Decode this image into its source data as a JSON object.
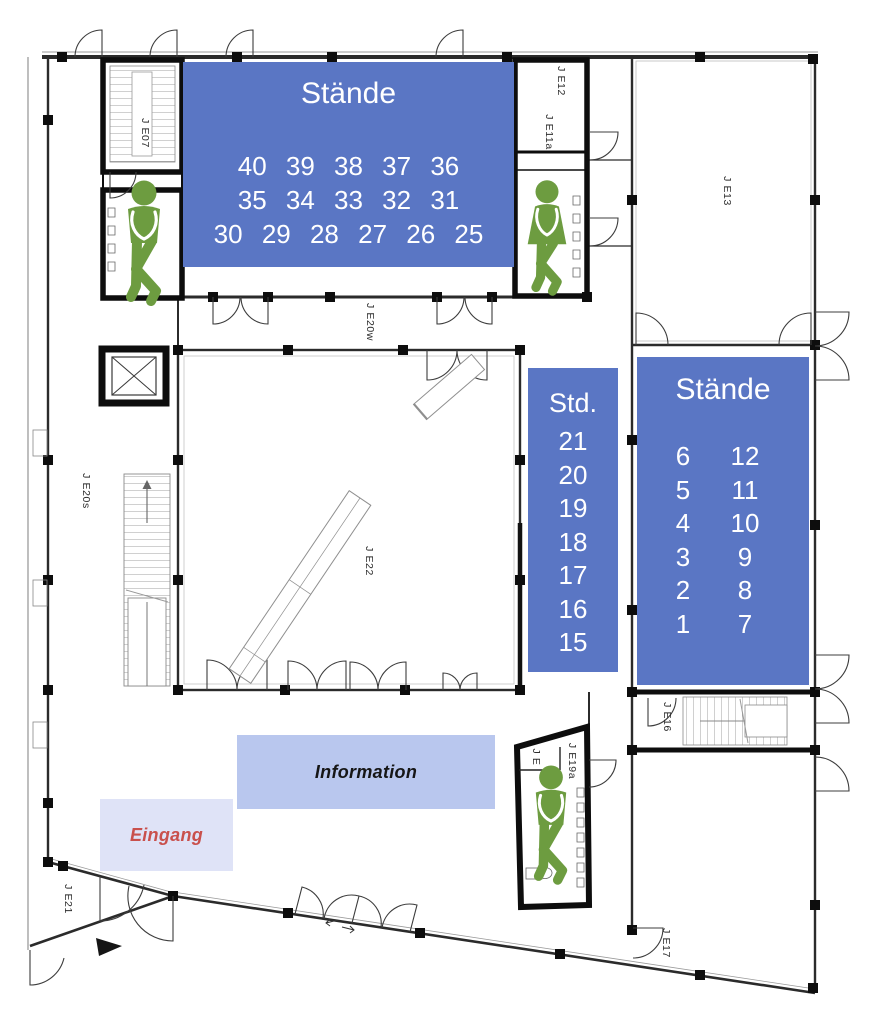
{
  "palette": {
    "stand_blue": "#5a76c4",
    "info_blue": "#b9c7ee",
    "entrance_lavender": "#dfe3f7",
    "entrance_red": "#c9504c",
    "wc_green": "#6d9c40"
  },
  "stands_top": {
    "title": "Stände",
    "rows": [
      "40 39 38 37 36",
      "35 34 33 32 31",
      "30 29 28 27 26 25"
    ]
  },
  "stands_mid": {
    "title": "Std.",
    "items": [
      "21",
      "20",
      "19",
      "18",
      "17",
      "16",
      "15"
    ]
  },
  "stands_right": {
    "title": "Stände",
    "left_column": [
      "6",
      "5",
      "4",
      "3",
      "2",
      "1"
    ],
    "right_column": [
      "12",
      "11",
      "10",
      "9",
      "8",
      "7"
    ]
  },
  "info_box": {
    "label": "Information"
  },
  "entrance_box": {
    "label": "Eingang"
  },
  "room_labels": {
    "je07": "J E07",
    "je12": "J E12",
    "je11a": "J E11a",
    "je13": "J E13",
    "je20w": "J E20w",
    "je20s": "J E20s",
    "je22": "J E22",
    "je16": "J E16",
    "je19": "J E",
    "je19a": "J E19a",
    "je21": "J E21",
    "je17": "J E17"
  },
  "icons": {
    "wc_male": "wc-male-pictogram",
    "wc_female": "wc-female-pictogram",
    "entrance_arrow": "entrance-arrow-icon"
  }
}
